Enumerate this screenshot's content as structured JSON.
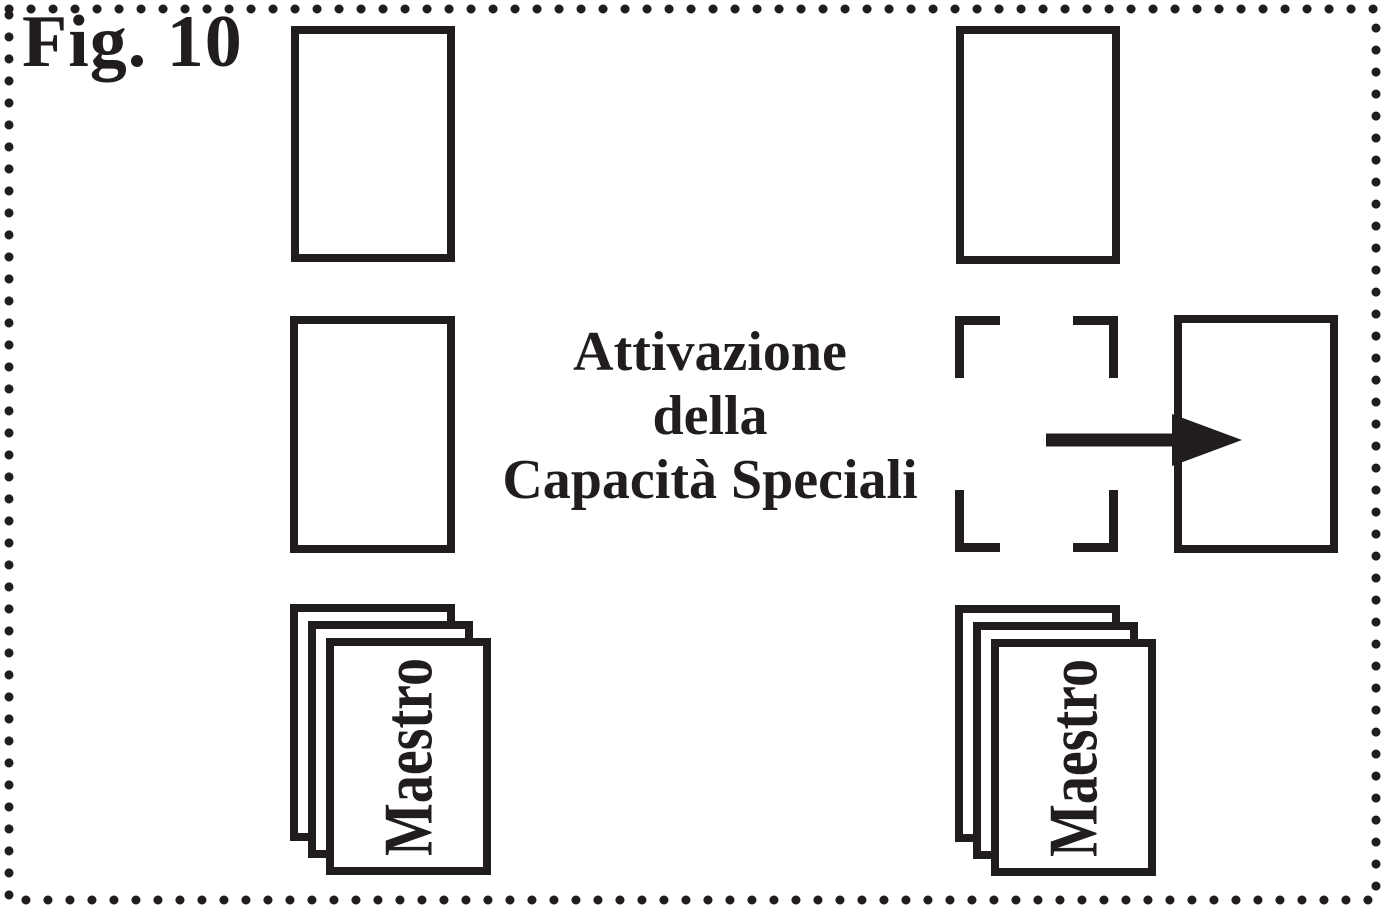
{
  "page": {
    "figure_label": "Fig. 10"
  },
  "caption": {
    "line1": "Attivazione",
    "line2": "della",
    "line3": "Capacità Speciali"
  },
  "decks": {
    "left": {
      "label": "Maestro"
    },
    "right": {
      "label": "Maestro"
    }
  },
  "icons": {
    "arrow": "arrow-right-icon",
    "border": "dotted-page-border"
  },
  "colors": {
    "ink": "#211d1e",
    "paper": "#ffffff"
  }
}
